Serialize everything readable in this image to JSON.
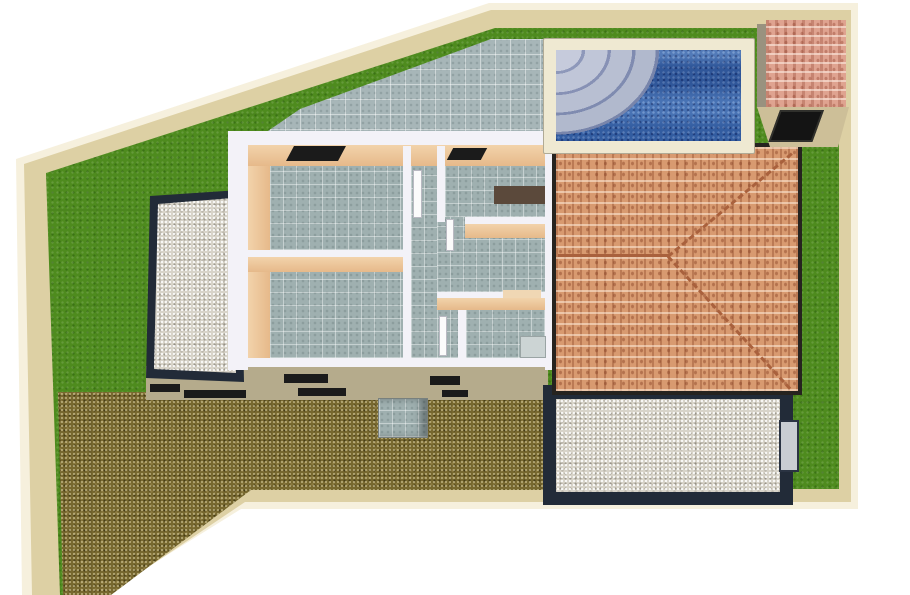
{
  "scene": {
    "type": "3d-architectural-site-plan-render",
    "regions": {
      "lawn": {
        "label": "Lawn"
      },
      "perimeter_wall": {
        "label": "Perimeter wall"
      },
      "terrace": {
        "label": "Tiled pool terrace"
      },
      "pool": {
        "label": "Swimming pool"
      },
      "pool_steps": {
        "label": "Pool corner steps"
      },
      "house": {
        "label": "House cutaway floor plan"
      },
      "roof": {
        "label": "Terracotta hip roof"
      },
      "shed": {
        "label": "Garden shed"
      },
      "driveway": {
        "label": "Gravel driveway"
      },
      "west_courtyard": {
        "label": "Walled gravel courtyard west"
      },
      "southeast_courtyard": {
        "label": "Walled gravel courtyard south east"
      },
      "facade": {
        "label": "South facade with windows"
      }
    }
  },
  "palette": {
    "wall_outer": "#f6f0dd",
    "wall": "#ddd0a4",
    "grass": "#4e8b1e",
    "terrace": "#a7b6b8",
    "floor": "#9fb0b0",
    "water": "#3a68ae",
    "pool_coping": "#efe9d2",
    "house_white": "#f3f2f8",
    "peach": "#e6b98a",
    "roof": "#d89a70",
    "roof_edge": "#26231f",
    "ridge": "#a9613d",
    "shed_roof": "#dfa390",
    "shed_fascia": "#cdbf98",
    "shed_wall": "#99927f",
    "shed_door": "#141414",
    "dark_wall": "#222b38",
    "white_gravel": "#d8d4c9",
    "brown_gravel": "#77682f",
    "facade": "#b5ab8c",
    "window": "#1b1b1b",
    "counter": "#5b493b",
    "stoop": "#adb5b2",
    "gate": "#c9cdd2",
    "door_white": "#fbfbfb"
  }
}
